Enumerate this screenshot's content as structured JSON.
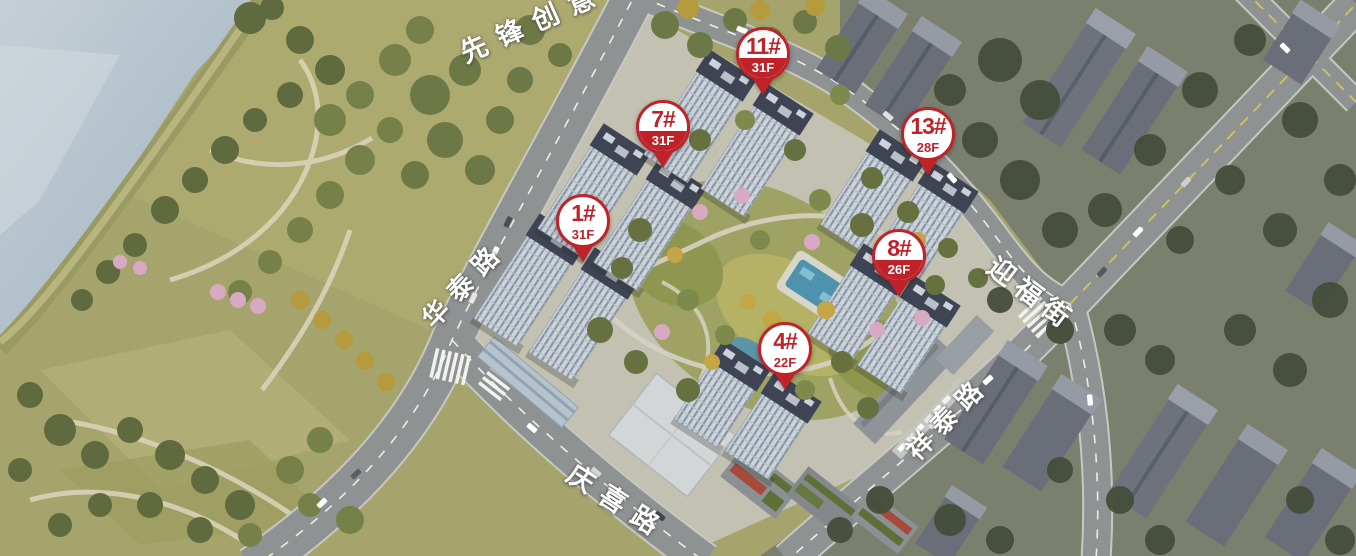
{
  "map": {
    "buildings": [
      {
        "label": "1#",
        "floors": "31F",
        "variant": "outline"
      },
      {
        "label": "4#",
        "floors": "22F",
        "variant": "outline"
      },
      {
        "label": "7#",
        "floors": "31F",
        "variant": "filled"
      },
      {
        "label": "8#",
        "floors": "26F",
        "variant": "filled"
      },
      {
        "label": "11#",
        "floors": "31F",
        "variant": "filled"
      },
      {
        "label": "13#",
        "floors": "28F",
        "variant": "outline"
      }
    ],
    "roads": {
      "north": "先锋创意",
      "west": "华泰路",
      "south": "庆喜路",
      "southeast": "祥泰路",
      "east": "迎福街"
    },
    "colors": {
      "pin_red": "#bf2329",
      "water": "#b7c3cc",
      "park_green": "#a5a46c",
      "road_gray": "#8f9292",
      "city_gray": "#7b7f6e",
      "tower_facade": "#ccd4dc",
      "tower_roof": "#3e4453",
      "pool_blue": "#4e93ad"
    }
  }
}
